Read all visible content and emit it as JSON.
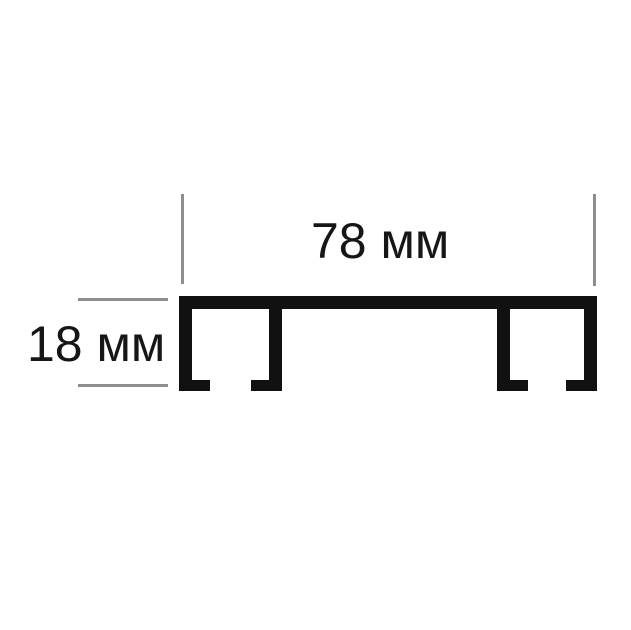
{
  "diagram": {
    "kind": "dimension-drawing",
    "width_label": "78 мм",
    "height_label": "18 мм",
    "width_value_mm": 78,
    "height_value_mm": 18,
    "unit": "мм",
    "colors": {
      "profile": "#111111",
      "dimension_line": "#8e8e8e",
      "text": "#161616",
      "background": "#ffffff"
    }
  }
}
